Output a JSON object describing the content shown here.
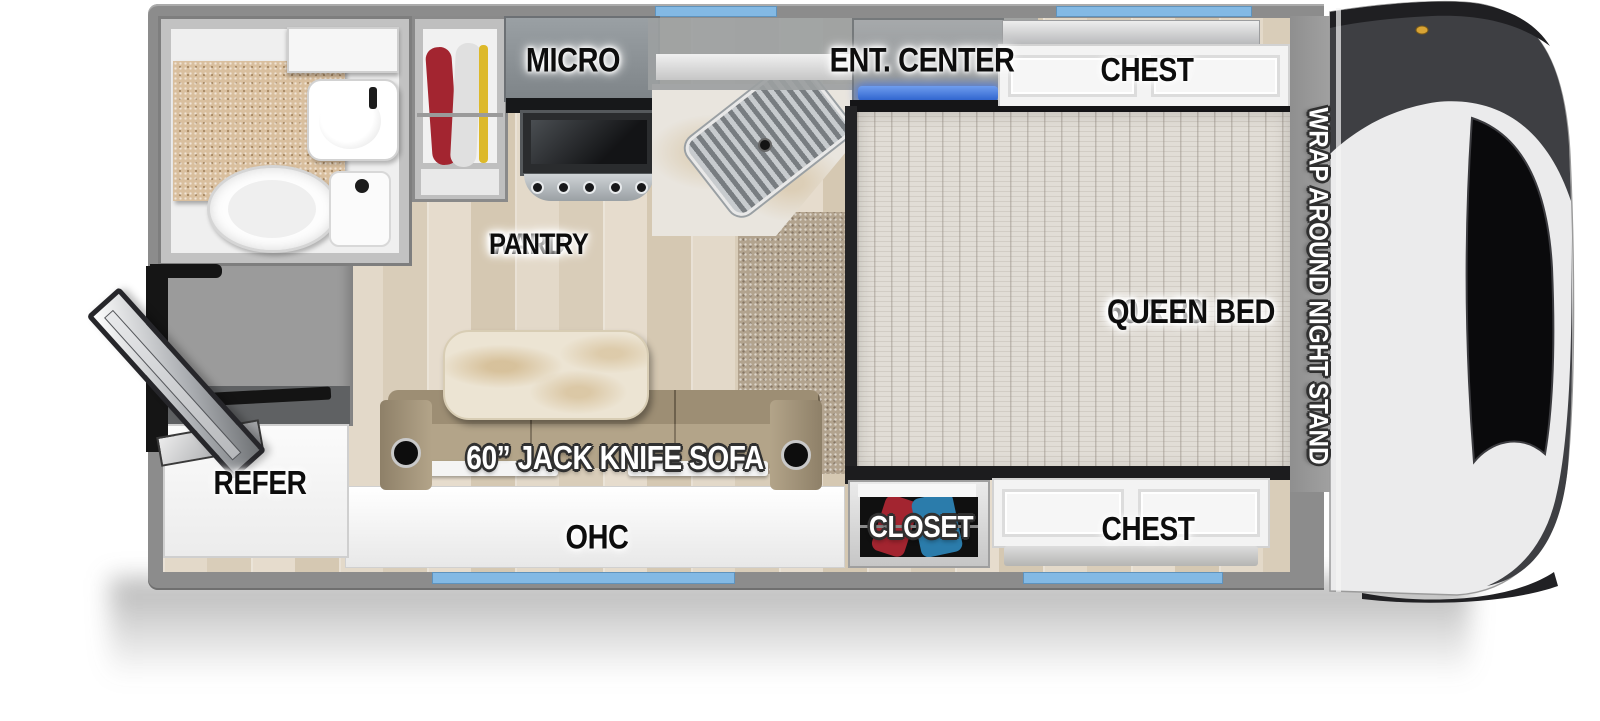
{
  "labels": {
    "micro": "MICRO",
    "ent_center": "ENT. CENTER",
    "chest_top": "CHEST",
    "ward": "WARD",
    "pantry": "PANTRY",
    "bed_size": "60 X 80",
    "bed_type": "QUEEN BED",
    "night_stand": "WRAP AROUND NIGHT STAND",
    "refer": "REFER",
    "sofa": "60” JACK KNIFE SOFA",
    "ohc": "OHC",
    "closet": "CLOSET",
    "chest_bottom": "CHEST"
  },
  "colors": {
    "wall": "#8c8c8c",
    "floor_wood": "#ddd1bf",
    "carpet": "#b2a38e",
    "mattress": "#e1ddd6",
    "sofa": "#b3a489",
    "window": "#83b9e4",
    "accent_blue": "#2d62cd",
    "counter_tan": "#d9bf9e",
    "cabinet_white": "#f3f3f3",
    "cap_dark": "#3e3f43",
    "cap_silver": "#ebebec",
    "clothes_red": "#a32530",
    "clothes_blue": "#2b7cab"
  }
}
